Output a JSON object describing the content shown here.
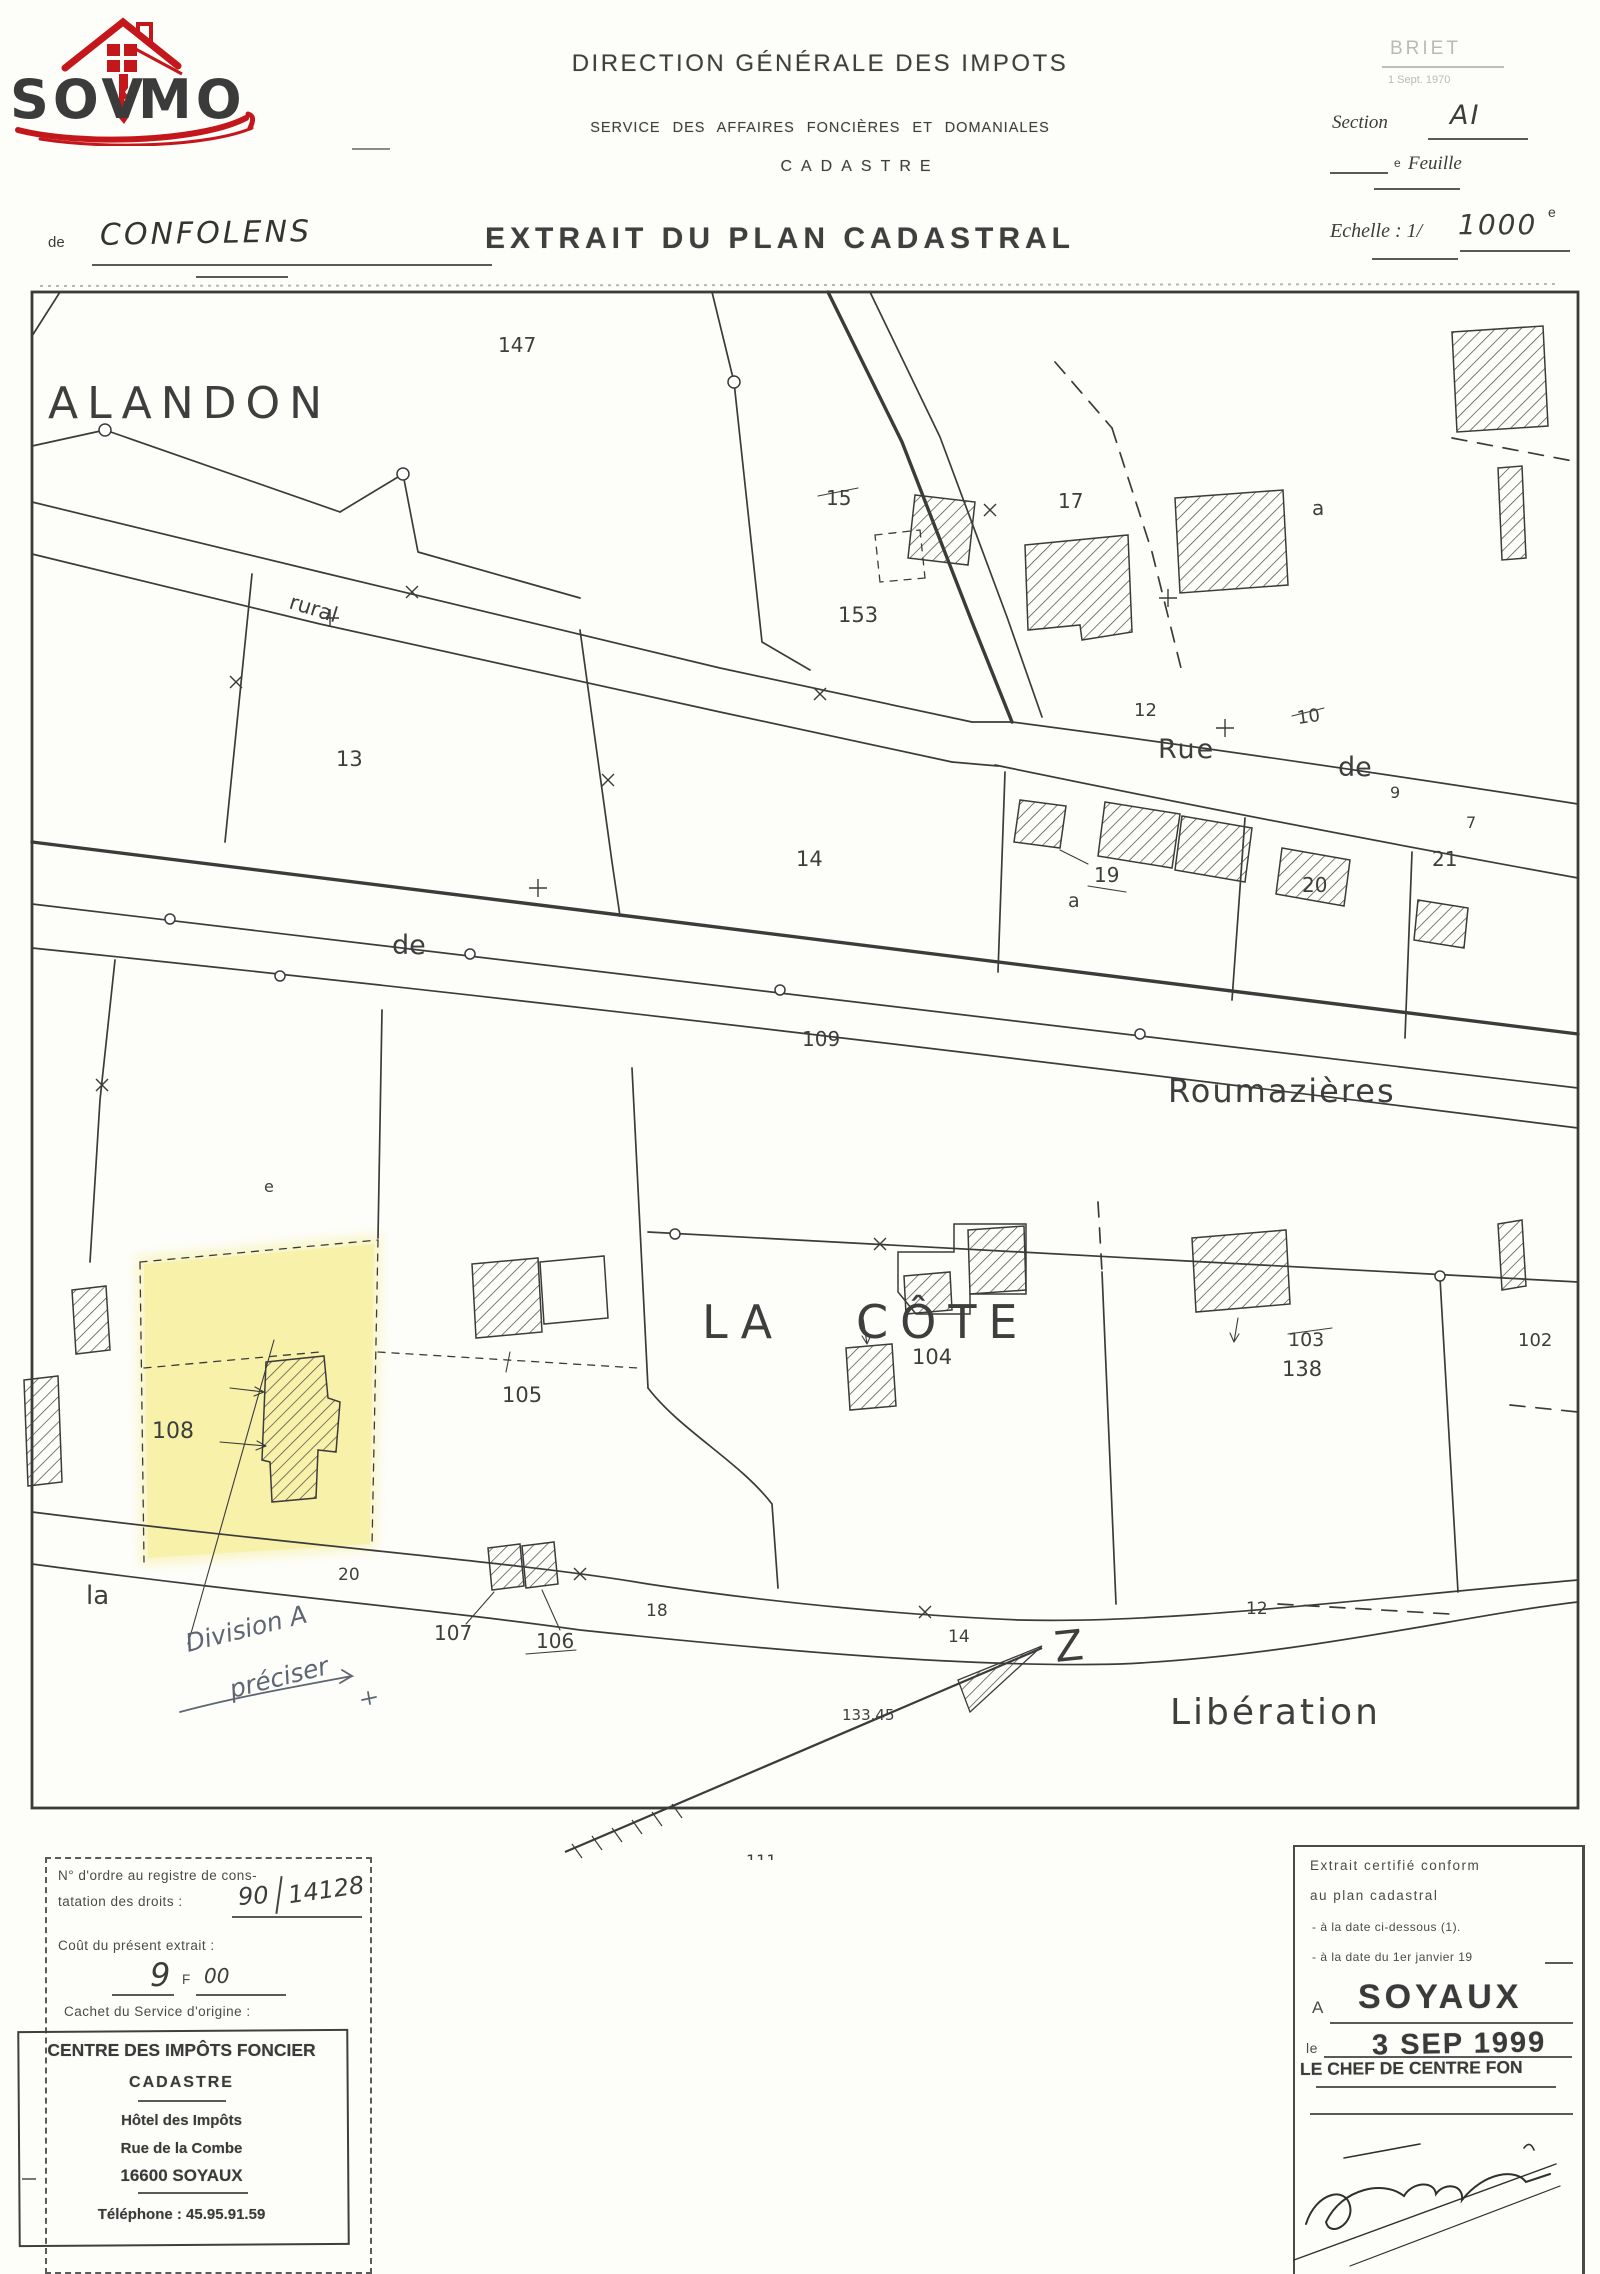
{
  "colors": {
    "accent_red": "#c4171c",
    "logo_gray": "#6a6a6a",
    "ink": "#3b3b3b",
    "highlight_yellow": "#f6f0a2",
    "pencil_blue": "#5d6672"
  },
  "logo": {
    "text_left": "SOV",
    "text_right": "MO",
    "house_icon": "red-house-key"
  },
  "header": {
    "agency_line1": "DIRECTION GÉNÉRALE DES IMPOTS",
    "agency_line2": "SERVICE  DES  AFFAIRES  FONCIÈRES  ET  DOMANIALES",
    "agency_line3": "CADASTRE",
    "title": "EXTRAIT DU PLAN CADASTRAL",
    "commune_prefix": "de",
    "commune": "CONFOLENS",
    "corner_stamp_name": "BRIET",
    "corner_stamp_date": "1 Sept. 1970",
    "section_label": "Section",
    "section_value": "AI",
    "feuille_sup": "e",
    "feuille_label": "Feuille",
    "echelle_label": "Echelle : 1/",
    "echelle_value": "1000",
    "echelle_sup": "e"
  },
  "map": {
    "labels": {
      "alandon": "ALANDON",
      "p147": "147",
      "rural": "rural",
      "p15": "15",
      "p153": "153",
      "p17": "17",
      "a_top": "a",
      "n12": "12",
      "rue": "Rue",
      "n10": "10",
      "de_rue": "de",
      "n9": "9",
      "n7": "7",
      "p19": "19",
      "p13": "13",
      "p14": "14",
      "a_mid": "a",
      "p20": "20",
      "p21": "21",
      "de_road": "de",
      "r109": "109",
      "roumazieres": "Roumazières",
      "p_e": "e",
      "p108": "108",
      "p105": "105",
      "p107": "107",
      "p106": "106",
      "la_big": "LA",
      "cote_big": "CÔTE",
      "p104": "104",
      "p103": "103",
      "p138": "138",
      "p102": "102",
      "la_road": "la",
      "n20": "20",
      "n18": "18",
      "n14": "14",
      "n12b": "12",
      "d133": "133.45",
      "liberation": "Libération",
      "p111": "111",
      "north": "Z",
      "hand_division1": "Division A",
      "hand_division2": "préciser"
    }
  },
  "box_left": {
    "l1": "N° d'ordre au registre de cons-",
    "l2": "tatation des droits :",
    "hand_num1": "90",
    "hand_num2": "14128",
    "l3": "Coût du présent extrait :",
    "hand_cost": "9",
    "cost_currency": "F",
    "hand_cents": "00",
    "l4": "Cachet du Service d'origine :",
    "stamp_line1": "CENTRE DES IMPÔTS FONCIER",
    "stamp_line2": "CADASTRE",
    "stamp_line3": "Hôtel des Impôts",
    "stamp_line4": "Rue de la Combe",
    "stamp_line5": "16600 SOYAUX",
    "stamp_line6": "Téléphone : 45.95.91.59"
  },
  "box_right": {
    "l1": "Extrait certifié conform",
    "l2": "au plan cadastral",
    "l3": "- à la date ci-dessous (1).",
    "l4": "- à la date du 1er janvier 19",
    "a_label": "A",
    "city_stamp": "SOYAUX",
    "le_label": "le",
    "date_stamp": "3 SEP 1999",
    "chief_stamp": "LE CHEF DE CENTRE FON"
  }
}
